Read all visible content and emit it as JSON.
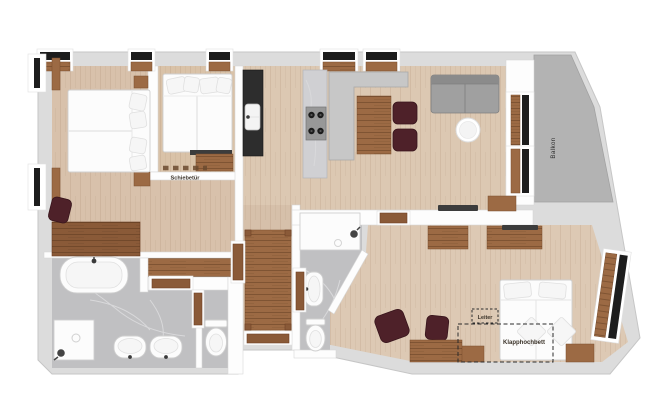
{
  "plan": {
    "labels": {
      "sliding_door": "Schiebetür",
      "balcony": "Balkon",
      "ladder": "Leiter",
      "fold_down_bed": "Klapphochbett"
    },
    "colors": {
      "exterior_wall": "#dcdcdc",
      "interior_wall": "#fdfdfd",
      "floor_light_wood": "#d9c3ac",
      "floor_walnut": "#9c6a44",
      "wardrobe_walnut": "#8a5a38",
      "floor_marble": "#c0c0c2",
      "balcony_floor": "#b3b3b3",
      "window_glass": "#1d1d1d",
      "door_wood": "#8a5a38",
      "chair_upholstery": "#4e2129",
      "sofa_gray": "#a0a0a0",
      "counter_gray": "#c7c7c7",
      "kitchen_block_dark": "#2d2d2d",
      "fixture_white": "#fcfcfc"
    }
  }
}
